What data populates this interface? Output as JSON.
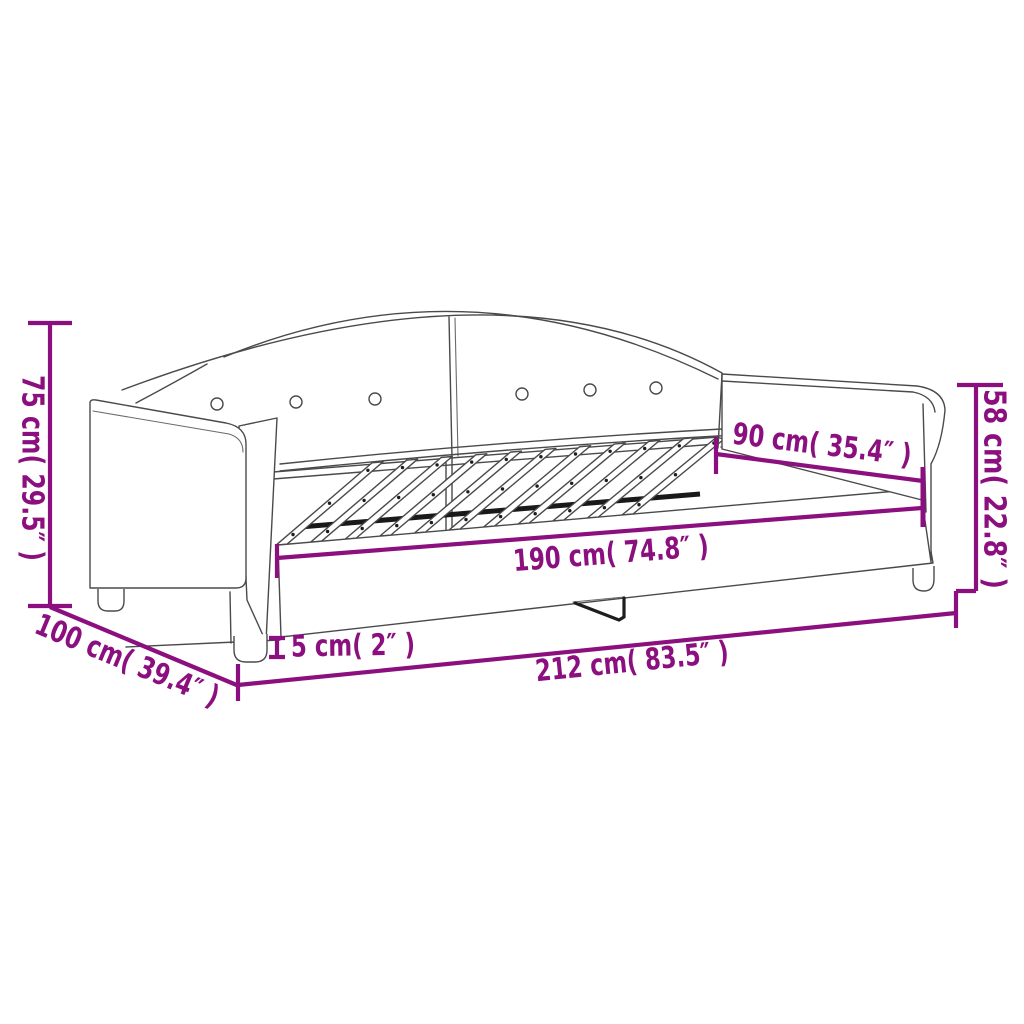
{
  "diagram": {
    "type": "product-dimension-diagram",
    "product": "daybed-with-slatted-base",
    "accent_color": "#8B0F7E",
    "line_color": "#4a4a4a",
    "labels": {
      "height_left": "75 cm( 29.5″ )",
      "height_right": "58 cm( 22.8″ )",
      "width_inner": "90 cm( 35.4″ )",
      "length_inner": "190 cm( 74.8″ )",
      "leg_height": "5 cm( 2″ )",
      "length_total": "212 cm( 83.5″ )",
      "width_total": "100 cm( 39.4″ )"
    },
    "slat_count": 11,
    "button_count": 6
  }
}
